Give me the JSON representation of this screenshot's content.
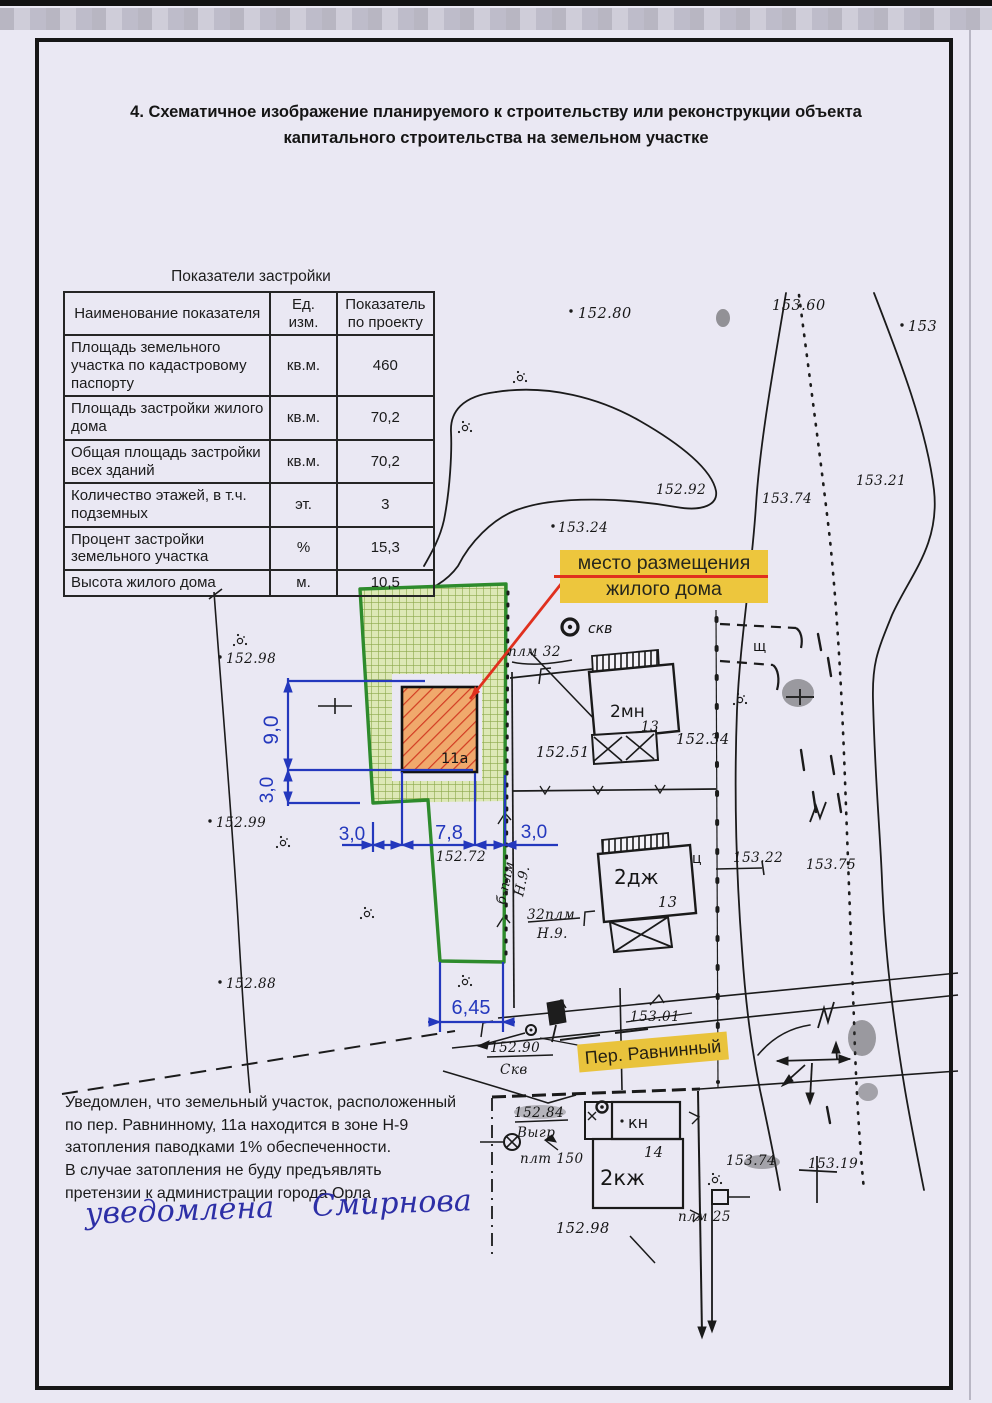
{
  "doc": {
    "title_line1": "4. Схематичное изображение планируемого к строительству или реконструкции объекта",
    "title_line2": "капитального строительства на земельном участке"
  },
  "table": {
    "title": "Показатели застройки",
    "headers": {
      "name": "Наименование показателя",
      "unit": "Ед. изм.",
      "value": "Показатель по проекту"
    },
    "rows": [
      {
        "name": "Площадь земельного участка по кадастровому паспорту",
        "unit": "кв.м.",
        "value": "460"
      },
      {
        "name": "Площадь застройки жилого дома",
        "unit": "кв.м.",
        "value": "70,2"
      },
      {
        "name": "Общая площадь застройки всех зданий",
        "unit": "кв.м.",
        "value": "70,2"
      },
      {
        "name": "Количество этажей, в т.ч. подземных",
        "unit": "эт.",
        "value": "3"
      },
      {
        "name": "Процент застройки земельного участка",
        "unit": "%",
        "value": "15,3"
      },
      {
        "name": "Высота жилого дома",
        "unit": "м.",
        "value": "10,5"
      }
    ]
  },
  "map": {
    "callout": {
      "line1": "место размещения",
      "line2": "жилого дома"
    },
    "street": "Пер. Равнинный",
    "house_label": "11а",
    "well_label": "скв",
    "dims": {
      "depth": "9,0",
      "side": "3,0",
      "left": "3,0",
      "width": "7,8",
      "right": "3,0",
      "front": "6,45",
      "base_mark": "152.72"
    },
    "elev": {
      "e152_80": "152.80",
      "e153_60": "153.60",
      "e153": "153",
      "e152_92": "152.92",
      "e153_74t": "153.74",
      "e153_21": "153.21",
      "e153_24": "153.24",
      "e152_98l": "152.98",
      "e152_99": "152.99",
      "e152_88": "152.88",
      "e152_51": "152.51",
      "e152_34": "152.34",
      "e153_22": "153.22",
      "e153_75": "153.75",
      "e153_01": "153.01",
      "e152_98c": "152.98",
      "e153_74b": "153.74",
      "e153_19": "153.19"
    },
    "fractions": {
      "f1top": "152.90",
      "f1bot": "Скв",
      "f2top": "152.84",
      "f2bot": "Выгр"
    },
    "features": {
      "plm32": "плм 32",
      "plm32b": "32плм",
      "n9": "Н.9.",
      "bplm": "б-плм",
      "n9r": "Н.9.",
      "b2mn": "2мн",
      "b2mn_no": "13",
      "b2dzh": "2дж",
      "b2dzh_no": "13",
      "b2kzh": "2кж",
      "kn": "кн",
      "n14": "14",
      "plt150": "плт 150",
      "plm25": "плм 25",
      "shch": "щ",
      "ts": "ц"
    }
  },
  "notice": {
    "lines": [
      "Уведомлен, что земельный участок, расположенный",
      "по пер. Равнинному, 11а находится в зоне Н-9",
      "затопления паводками 1% обеспеченности.",
      "В случае затопления не буду предъявлять",
      "претензии к администрации города Орла"
    ]
  },
  "signature": {
    "text": "уведомлена    Смирнова"
  }
}
